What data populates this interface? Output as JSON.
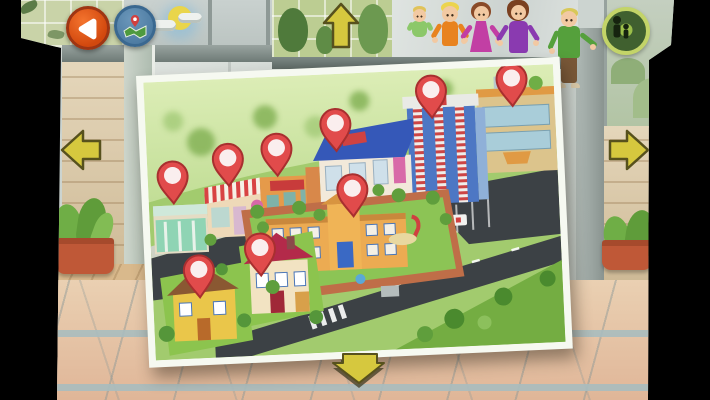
{
  "screen": {
    "kind": "town-map-selection",
    "colors": {
      "pin_fill": "#e14b4b",
      "pin_border": "#a82f2f",
      "pin_dot": "#ffffff",
      "arrow_fill": "#d6c83e",
      "arrow_outline": "#57511d",
      "back_button_bg": "#d2480e",
      "map_button_bg": "#4d7ba2",
      "photo_border": "#f6f9f1"
    }
  },
  "toolbar": {
    "back_button": {
      "icon": "back-triangle-icon",
      "aria": "back"
    },
    "map_button": {
      "icon": "map-with-pin-icon",
      "aria": "map view"
    }
  },
  "nav_arrows": {
    "up": {
      "icon": "up-arrow-icon",
      "aria": "go up"
    },
    "down": {
      "icon": "down-arrow-icon",
      "aria": "go down"
    },
    "left": {
      "icon": "left-arrow-icon",
      "aria": "go left"
    },
    "right": {
      "icon": "right-arrow-icon",
      "aria": "go right"
    }
  },
  "door_sign": {
    "icon": "adult-and-child-silhouette-icon"
  },
  "window_mural": {
    "icon": "sun-and-clouds-icon"
  },
  "characters": [
    {
      "id": "baby",
      "skin": "#f2c9a2",
      "hair": "#e0c35a",
      "outfit": "#8cc86a"
    },
    {
      "id": "boy",
      "skin": "#f2c9a2",
      "hair": "#ecd44e",
      "outfit": "#e8831f"
    },
    {
      "id": "girl",
      "skin": "#f2c9a2",
      "hair": "#8a4a28",
      "outfit": "#c23fa4"
    },
    {
      "id": "woman",
      "skin": "#f2c9a2",
      "hair": "#7a4020",
      "outfit": "#8a3ab0"
    },
    {
      "id": "man",
      "skin": "#f2c9a2",
      "hair": "#d8c858",
      "outfit": "#55a03c",
      "pants": "#7a5838"
    }
  ],
  "map": {
    "pins": [
      {
        "id": "grocery-store",
        "x": 25,
        "y": 96
      },
      {
        "id": "cafe",
        "x": 81,
        "y": 81
      },
      {
        "id": "theater",
        "x": 130,
        "y": 73
      },
      {
        "id": "shops",
        "x": 190,
        "y": 51
      },
      {
        "id": "hospital",
        "x": 287,
        "y": 22
      },
      {
        "id": "mall",
        "x": 368,
        "y": 14
      },
      {
        "id": "school",
        "x": 204,
        "y": 117
      },
      {
        "id": "yellow-house",
        "x": 47,
        "y": 191
      },
      {
        "id": "red-house",
        "x": 109,
        "y": 172
      }
    ]
  }
}
